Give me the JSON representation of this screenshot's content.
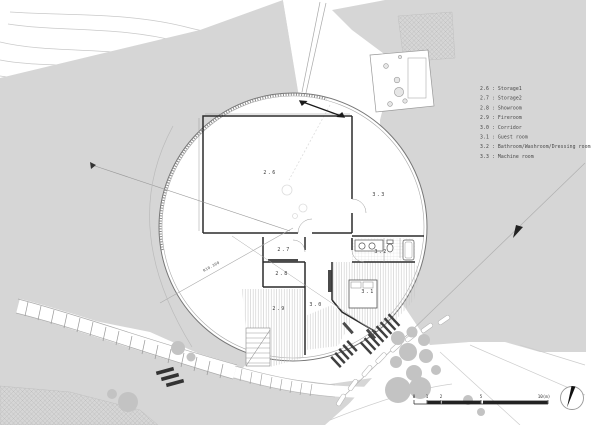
{
  "drawing": {
    "kind": "architectural site and floor plan, circular building",
    "radius_label": "R10.300"
  },
  "legend": {
    "items": [
      {
        "text": "2.6 : Storage1"
      },
      {
        "text": "2.7 : Storage2"
      },
      {
        "text": "2.8 : Showroom"
      },
      {
        "text": "2.9 : Fireroom"
      },
      {
        "text": "3.0 : Corridor"
      },
      {
        "text": "3.1 : Guest room"
      },
      {
        "text": "3.2 : Bathroom/Washroom/Dressing room"
      },
      {
        "text": "3.3 : Machine room"
      }
    ]
  },
  "rooms": [
    {
      "id": "2.6"
    },
    {
      "id": "3.3"
    },
    {
      "id": "2.7"
    },
    {
      "id": "2.8"
    },
    {
      "id": "2.9"
    },
    {
      "id": "3.0"
    },
    {
      "id": "3.1"
    },
    {
      "id": "3.2"
    }
  ],
  "scale_bar": {
    "labels": [
      "0",
      "1",
      "2",
      "5"
    ],
    "end_label": "10(m)"
  },
  "colors": {
    "terrain": "#d6d6d6",
    "tree": "#c3c3c3",
    "wall": "#2b2b2b",
    "hatch": "#c6c6c6",
    "slat": "#3f3f3f"
  }
}
